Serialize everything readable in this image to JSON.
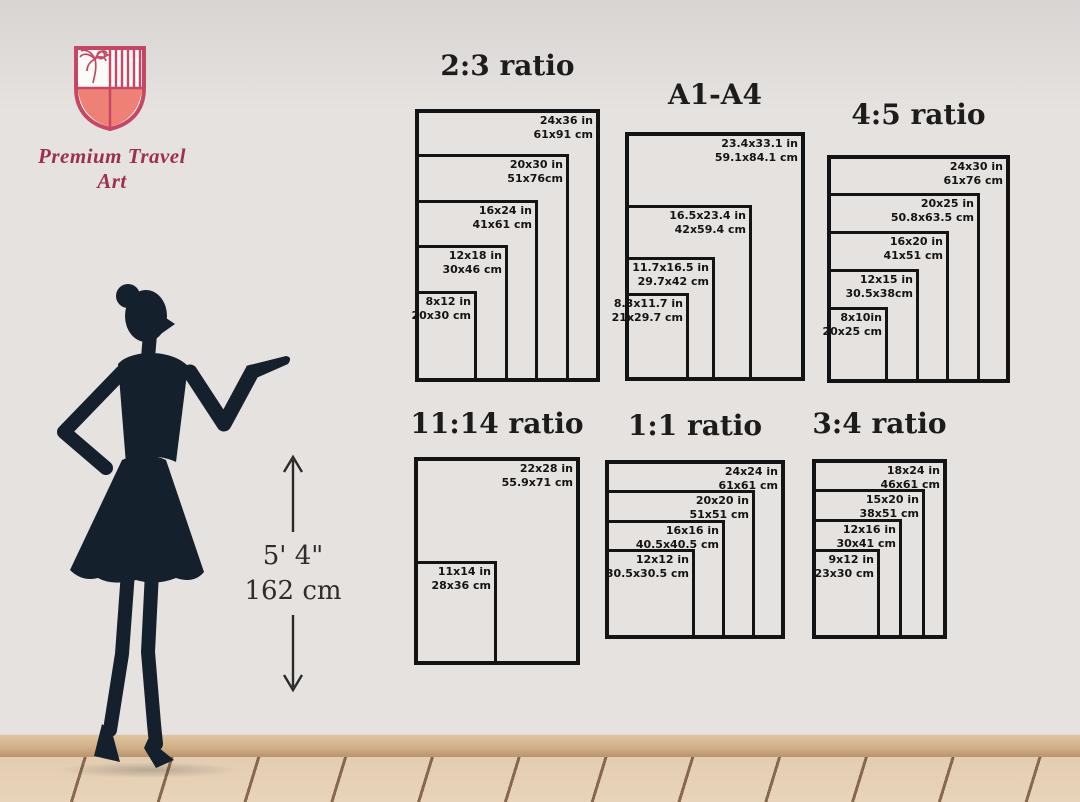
{
  "brand": {
    "name": "Premium Travel Art"
  },
  "icons": {
    "logo": "shield-icon",
    "up": "arrow-up-icon",
    "down": "arrow-down-icon"
  },
  "colors": {
    "diagram_border": "#141414",
    "title_text": "#1d1c1b",
    "brand_text": "#9c3050",
    "shield_outline": "#c64763",
    "shield_fill": "#ef8076",
    "silhouette": "#14202c",
    "baseboard": "#d2b189",
    "floor_wood": "#e3cdb2"
  },
  "height_reference": {
    "feet": "5' 4\"",
    "cm": "162 cm"
  },
  "diagrams": [
    {
      "id": "ratio-2-3",
      "title": "2:3 ratio",
      "sizes": [
        {
          "inches": "24x36 in",
          "cm": "61x91 cm",
          "w": 24,
          "h": 36
        },
        {
          "inches": "20x30 in",
          "cm": "51x76cm",
          "w": 20,
          "h": 30
        },
        {
          "inches": "16x24 in",
          "cm": "41x61 cm",
          "w": 16,
          "h": 24
        },
        {
          "inches": "12x18 in",
          "cm": "30x46 cm",
          "w": 12,
          "h": 18
        },
        {
          "inches": "8x12 in",
          "cm": "20x30 cm",
          "w": 8,
          "h": 12
        }
      ]
    },
    {
      "id": "a1-a4",
      "title": "A1-A4",
      "sizes": [
        {
          "inches": "23.4x33.1 in",
          "cm": "59.1x84.1 cm",
          "w": 23.4,
          "h": 33.1
        },
        {
          "inches": "16.5x23.4 in",
          "cm": "42x59.4 cm",
          "w": 16.5,
          "h": 23.4
        },
        {
          "inches": "11.7x16.5 in",
          "cm": "29.7x42 cm",
          "w": 11.7,
          "h": 16.5
        },
        {
          "inches": "8.3x11.7 in",
          "cm": "21x29.7 cm",
          "w": 8.3,
          "h": 11.7
        }
      ]
    },
    {
      "id": "ratio-4-5",
      "title": "4:5 ratio",
      "sizes": [
        {
          "inches": "24x30 in",
          "cm": "61x76 cm",
          "w": 24,
          "h": 30
        },
        {
          "inches": "20x25 in",
          "cm": "50.8x63.5 cm",
          "w": 20,
          "h": 25
        },
        {
          "inches": "16x20 in",
          "cm": "41x51 cm",
          "w": 16,
          "h": 20
        },
        {
          "inches": "12x15 in",
          "cm": "30.5x38cm",
          "w": 12,
          "h": 15
        },
        {
          "inches": "8x10in",
          "cm": "20x25 cm",
          "w": 8,
          "h": 10
        }
      ]
    },
    {
      "id": "ratio-11-14",
      "title": "11:14 ratio",
      "sizes": [
        {
          "inches": "22x28 in",
          "cm": "55.9x71 cm",
          "w": 22,
          "h": 28
        },
        {
          "inches": "11x14 in",
          "cm": "28x36 cm",
          "w": 11,
          "h": 14
        }
      ]
    },
    {
      "id": "ratio-1-1",
      "title": "1:1 ratio",
      "sizes": [
        {
          "inches": "24x24 in",
          "cm": "61x61 cm",
          "w": 24,
          "h": 24
        },
        {
          "inches": "20x20 in",
          "cm": "51x51 cm",
          "w": 20,
          "h": 20
        },
        {
          "inches": "16x16 in",
          "cm": "40.5x40.5 cm",
          "w": 16,
          "h": 16
        },
        {
          "inches": "12x12 in",
          "cm": "30.5x30.5 cm",
          "w": 12,
          "h": 12
        }
      ]
    },
    {
      "id": "ratio-3-4",
      "title": "3:4 ratio",
      "sizes": [
        {
          "inches": "18x24 in",
          "cm": "46x61 cm",
          "w": 18,
          "h": 24
        },
        {
          "inches": "15x20 in",
          "cm": "38x51 cm",
          "w": 15,
          "h": 20
        },
        {
          "inches": "12x16 in",
          "cm": "30x41 cm",
          "w": 12,
          "h": 16
        },
        {
          "inches": "9x12 in",
          "cm": "23x30 cm",
          "w": 9,
          "h": 12
        }
      ]
    }
  ]
}
